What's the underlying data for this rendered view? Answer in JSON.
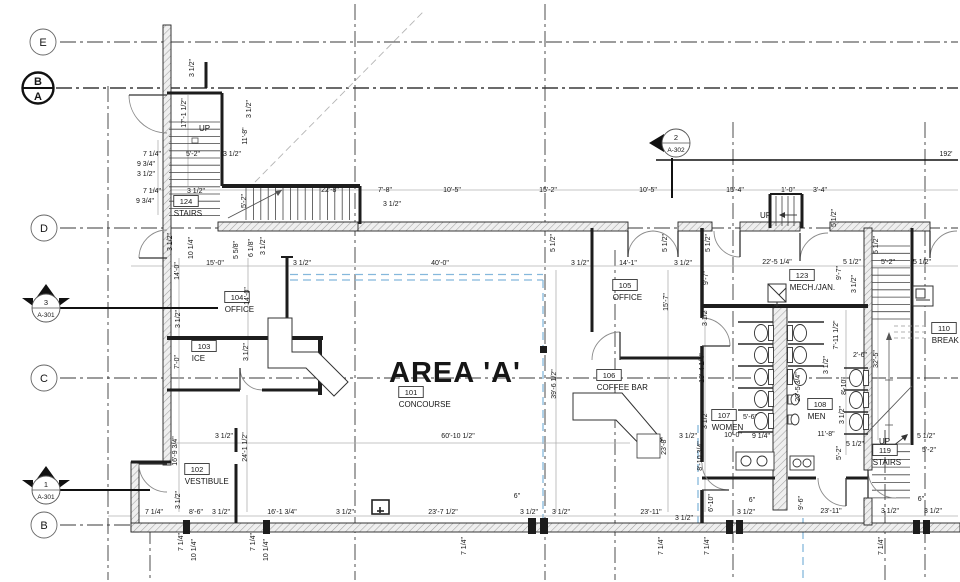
{
  "drawing": {
    "area_title": "AREA 'A'",
    "overall_dim": "192'",
    "up_text": "UP"
  },
  "colors": {
    "wall": "#1c1c1c",
    "dim_text": "#161616",
    "dim_line": "#b0b0b0",
    "grid_line": "#3a3a3a",
    "area_boundary_blue": "#85b8dc",
    "background": "#ffffff"
  },
  "grid_bubbles": [
    {
      "label": "E",
      "x": 43,
      "y": 42,
      "style": "light"
    },
    {
      "label": "B",
      "label2": "A",
      "x": 38,
      "y": 88,
      "style": "bold"
    },
    {
      "label": "D",
      "x": 44,
      "y": 228,
      "style": "light"
    },
    {
      "label": "C",
      "x": 44,
      "y": 378,
      "style": "light"
    },
    {
      "label": "B",
      "x": 44,
      "y": 525,
      "style": "light"
    }
  ],
  "section_markers": [
    {
      "number": "3",
      "sheet": "A-301",
      "x": 46,
      "y": 308,
      "dir": "up"
    },
    {
      "number": "1",
      "sheet": "A-301",
      "x": 46,
      "y": 490,
      "dir": "up"
    },
    {
      "number": "2",
      "sheet": "A-302",
      "x": 676,
      "y": 143,
      "dir": "left"
    }
  ],
  "rooms": [
    {
      "number": "124",
      "name": "STAIRS",
      "x": 186,
      "y": 204
    },
    {
      "number": "104",
      "name": "OFFICE",
      "x": 237,
      "y": 300
    },
    {
      "number": "103",
      "name": "ICE",
      "x": 204,
      "y": 349
    },
    {
      "number": "102",
      "name": "VESTIBULE",
      "x": 197,
      "y": 472
    },
    {
      "number": "101",
      "name": "CONCOURSE",
      "x": 411,
      "y": 395
    },
    {
      "number": "105",
      "name": "OFFICE",
      "x": 625,
      "y": 288
    },
    {
      "number": "106",
      "name": "COFFEE BAR",
      "x": 609,
      "y": 378
    },
    {
      "number": "123",
      "name": "MECH./JAN.",
      "x": 802,
      "y": 278
    },
    {
      "number": "107",
      "name": "WOMEN",
      "x": 724,
      "y": 418
    },
    {
      "number": "108",
      "name": "MEN",
      "x": 820,
      "y": 407
    },
    {
      "number": "119",
      "name": "STAIRS",
      "x": 885,
      "y": 453
    },
    {
      "number": "110",
      "name": "BREAK",
      "x": 944,
      "y": 331
    }
  ],
  "up_labels": [
    {
      "t": "UP",
      "x": 199,
      "y": 131
    },
    {
      "t": "UP",
      "x": 760,
      "y": 218
    },
    {
      "t": "UP",
      "x": 879,
      "y": 444
    }
  ],
  "dimensions": [
    {
      "t": "7 1/4\"",
      "x": 152,
      "y": 156
    },
    {
      "t": "9 3/4\"",
      "x": 146,
      "y": 166
    },
    {
      "t": "3 1/2\"",
      "x": 146,
      "y": 176
    },
    {
      "t": "7 1/4\"",
      "x": 152,
      "y": 193
    },
    {
      "t": "9 3/4\"",
      "x": 145,
      "y": 203
    },
    {
      "t": "5'-2\"",
      "x": 193,
      "y": 156
    },
    {
      "t": "3 1/2\"",
      "x": 232,
      "y": 156
    },
    {
      "t": "3 1/2\"",
      "x": 196,
      "y": 193
    },
    {
      "t": "17'-1 1/2\"",
      "x": 186,
      "y": 113,
      "r": 1
    },
    {
      "t": "11'-8\"",
      "x": 247,
      "y": 136,
      "r": 1
    },
    {
      "t": "5'-2\"",
      "x": 246,
      "y": 201,
      "r": 1
    },
    {
      "t": "3 1/2\"",
      "x": 194,
      "y": 68,
      "r": 1
    },
    {
      "t": "3 1/2\"",
      "x": 251,
      "y": 109,
      "r": 1
    },
    {
      "t": "22'-8\"",
      "x": 330,
      "y": 192
    },
    {
      "t": "7'-8\"",
      "x": 385,
      "y": 192
    },
    {
      "t": "10'-5\"",
      "x": 452,
      "y": 192
    },
    {
      "t": "15'-2\"",
      "x": 548,
      "y": 192
    },
    {
      "t": "10'-5\"",
      "x": 648,
      "y": 192
    },
    {
      "t": "15'-4\"",
      "x": 735,
      "y": 192
    },
    {
      "t": "1'-0\"",
      "x": 788,
      "y": 192
    },
    {
      "t": "3'-4\"",
      "x": 820,
      "y": 192
    },
    {
      "t": "3 1/2\"",
      "x": 392,
      "y": 206
    },
    {
      "t": "5 1/2\"",
      "x": 836,
      "y": 218,
      "r": 1
    },
    {
      "t": "192'",
      "x": 946,
      "y": 156
    },
    {
      "t": "15'-0\"",
      "x": 215,
      "y": 265
    },
    {
      "t": "3 1/2\"",
      "x": 302,
      "y": 265
    },
    {
      "t": "40'-0\"",
      "x": 440,
      "y": 265
    },
    {
      "t": "3 1/2\"",
      "x": 580,
      "y": 265
    },
    {
      "t": "14'-1\"",
      "x": 628,
      "y": 265
    },
    {
      "t": "3 1/2\"",
      "x": 683,
      "y": 265
    },
    {
      "t": "22'-5 1/4\"",
      "x": 777,
      "y": 264
    },
    {
      "t": "5 1/2\"",
      "x": 852,
      "y": 264
    },
    {
      "t": "5'-2\"",
      "x": 888,
      "y": 264
    },
    {
      "t": "5 1/2\"",
      "x": 922,
      "y": 264
    },
    {
      "t": "5 1/2\"",
      "x": 555,
      "y": 243,
      "r": 1
    },
    {
      "t": "5 1/2\"",
      "x": 667,
      "y": 243,
      "r": 1
    },
    {
      "t": "5 1/2\"",
      "x": 710,
      "y": 243,
      "r": 1
    },
    {
      "t": "5 1/2\"",
      "x": 878,
      "y": 245,
      "r": 1
    },
    {
      "t": "10 1/4\"",
      "x": 193,
      "y": 248,
      "r": 1
    },
    {
      "t": "3 1/2\"",
      "x": 172,
      "y": 242,
      "r": 1
    },
    {
      "t": "5 5/8\"",
      "x": 238,
      "y": 250,
      "r": 1
    },
    {
      "t": "6 1/8\"",
      "x": 253,
      "y": 248,
      "r": 1
    },
    {
      "t": "3 1/2\"",
      "x": 265,
      "y": 246,
      "r": 1
    },
    {
      "t": "14'-0\"",
      "x": 179,
      "y": 271,
      "r": 1
    },
    {
      "t": "14'-0\"",
      "x": 249,
      "y": 296,
      "r": 1
    },
    {
      "t": "3 1/2\"",
      "x": 180,
      "y": 319,
      "r": 1
    },
    {
      "t": "7'-0\"",
      "x": 179,
      "y": 362,
      "r": 1
    },
    {
      "t": "3 1/2\"",
      "x": 248,
      "y": 352,
      "r": 1
    },
    {
      "t": "16'-9 3/4\"",
      "x": 177,
      "y": 451,
      "r": 1
    },
    {
      "t": "3 1/2\"",
      "x": 180,
      "y": 500,
      "r": 1
    },
    {
      "t": "24'-1 1/2\"",
      "x": 247,
      "y": 447,
      "r": 1
    },
    {
      "t": "3 1/2\"",
      "x": 224,
      "y": 438
    },
    {
      "t": "39'-6 1/2\"",
      "x": 556,
      "y": 384,
      "r": 1
    },
    {
      "t": "60'-10 1/2\"",
      "x": 458,
      "y": 438
    },
    {
      "t": "15'-7\"",
      "x": 668,
      "y": 302,
      "r": 1
    },
    {
      "t": "9'-7\"",
      "x": 708,
      "y": 278,
      "r": 1
    },
    {
      "t": "9'-7\"",
      "x": 841,
      "y": 273,
      "r": 1
    },
    {
      "t": "3 1/2\"",
      "x": 856,
      "y": 284,
      "r": 1
    },
    {
      "t": "23'-8\"",
      "x": 666,
      "y": 446,
      "r": 1
    },
    {
      "t": "3 1/2\"",
      "x": 688,
      "y": 438
    },
    {
      "t": "3 1/2\"",
      "x": 707,
      "y": 317,
      "r": 1
    },
    {
      "t": "13'-4 1/4\"",
      "x": 704,
      "y": 368,
      "r": 1
    },
    {
      "t": "3 1/2\"",
      "x": 707,
      "y": 420,
      "r": 1
    },
    {
      "t": "8'-10 3/4\"",
      "x": 702,
      "y": 456,
      "r": 1
    },
    {
      "t": "7'-11 1/2\"",
      "x": 838,
      "y": 335,
      "r": 1
    },
    {
      "t": "3 1/2\"",
      "x": 828,
      "y": 365,
      "r": 1
    },
    {
      "t": "2'-6\"",
      "x": 860,
      "y": 357
    },
    {
      "t": "8'-10\"",
      "x": 846,
      "y": 386,
      "r": 1
    },
    {
      "t": "20'-5 3/4\"",
      "x": 800,
      "y": 387,
      "r": 1
    },
    {
      "t": "3 1/2\"",
      "x": 844,
      "y": 415,
      "r": 1
    },
    {
      "t": "5'-2\"",
      "x": 841,
      "y": 453,
      "r": 1
    },
    {
      "t": "5 1/2\"",
      "x": 855,
      "y": 446
    },
    {
      "t": "5'-6\"",
      "x": 750,
      "y": 419
    },
    {
      "t": "10'-0\"",
      "x": 733,
      "y": 437
    },
    {
      "t": "9 1/4\"",
      "x": 761,
      "y": 438
    },
    {
      "t": "11'-8\"",
      "x": 826,
      "y": 436
    },
    {
      "t": "6'-10\"",
      "x": 713,
      "y": 503,
      "r": 1
    },
    {
      "t": "9'-6\"",
      "x": 803,
      "y": 503,
      "r": 1
    },
    {
      "t": "5 1/2\"",
      "x": 926,
      "y": 438
    },
    {
      "t": "5'-2\"",
      "x": 929,
      "y": 452
    },
    {
      "t": "32'-5\"",
      "x": 878,
      "y": 359,
      "r": 1
    },
    {
      "t": "7 1/4\"",
      "x": 154,
      "y": 514
    },
    {
      "t": "8'-6\"",
      "x": 196,
      "y": 514
    },
    {
      "t": "3 1/2\"",
      "x": 221,
      "y": 514
    },
    {
      "t": "16'-1 3/4\"",
      "x": 282,
      "y": 514
    },
    {
      "t": "3 1/2\"",
      "x": 345,
      "y": 514
    },
    {
      "t": "23'-7 1/2\"",
      "x": 443,
      "y": 514
    },
    {
      "t": "6\"",
      "x": 517,
      "y": 498
    },
    {
      "t": "3 1/2\"",
      "x": 529,
      "y": 514
    },
    {
      "t": "3 1/2\"",
      "x": 561,
      "y": 514
    },
    {
      "t": "23'-11\"",
      "x": 651,
      "y": 514
    },
    {
      "t": "3 1/2\"",
      "x": 684,
      "y": 520
    },
    {
      "t": "6\"",
      "x": 752,
      "y": 502
    },
    {
      "t": "3 1/2\"",
      "x": 746,
      "y": 514
    },
    {
      "t": "23'-11\"",
      "x": 831,
      "y": 513
    },
    {
      "t": "6\"",
      "x": 921,
      "y": 501
    },
    {
      "t": "3 1/2\"",
      "x": 890,
      "y": 513
    },
    {
      "t": "3 1/2\"",
      "x": 933,
      "y": 513
    },
    {
      "t": "7 1/4\"",
      "x": 183,
      "y": 542,
      "r": 1
    },
    {
      "t": "10 1/4\"",
      "x": 196,
      "y": 550,
      "r": 1
    },
    {
      "t": "7 1/4\"",
      "x": 255,
      "y": 542,
      "r": 1
    },
    {
      "t": "10 1/4\"",
      "x": 268,
      "y": 550,
      "r": 1
    },
    {
      "t": "7 1/4\"",
      "x": 466,
      "y": 546,
      "r": 1
    },
    {
      "t": "7 1/4\"",
      "x": 663,
      "y": 546,
      "r": 1
    },
    {
      "t": "7 1/4\"",
      "x": 709,
      "y": 546,
      "r": 1
    },
    {
      "t": "7 1/4\"",
      "x": 883,
      "y": 546,
      "r": 1
    }
  ]
}
